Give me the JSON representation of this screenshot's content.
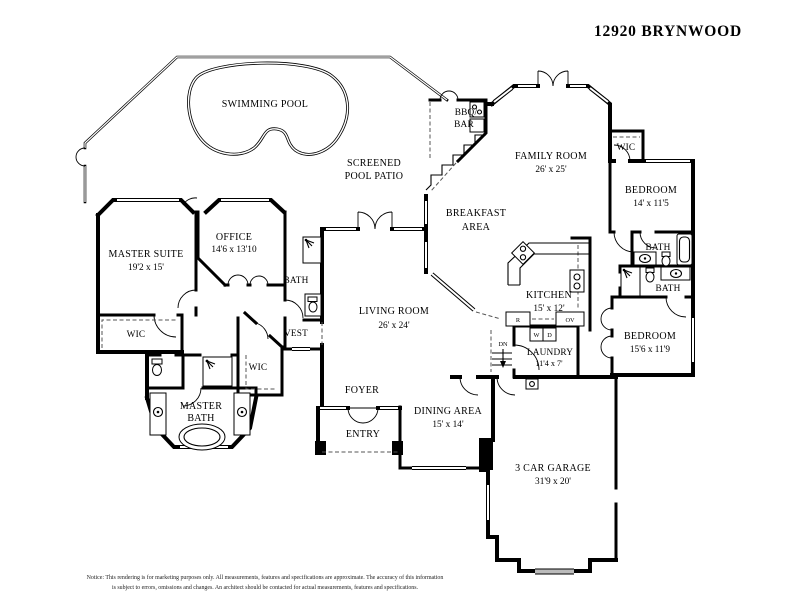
{
  "title": "12920 BRYNWOOD",
  "rooms": {
    "swimming_pool": {
      "label": "SWIMMING POOL"
    },
    "patio": {
      "line1": "SCREENED",
      "line2": "POOL PATIO"
    },
    "bbq_bar": {
      "line1": "BBQ/",
      "line2": "BAR"
    },
    "family_room": {
      "label": "FAMILY ROOM",
      "dim": "26' x 25'"
    },
    "wic_top": {
      "label": "WIC"
    },
    "bedroom1": {
      "label": "BEDROOM",
      "dim": "14' x 11'5"
    },
    "bath1": {
      "label": "BATH"
    },
    "bath2": {
      "label": "BATH"
    },
    "bedroom2": {
      "label": "BEDROOM",
      "dim": "15'6 x 11'9"
    },
    "breakfast": {
      "line1": "BREAKFAST",
      "line2": "AREA"
    },
    "kitchen": {
      "label": "KITCHEN",
      "dim": "15' x 12'"
    },
    "laundry": {
      "label": "LAUNDRY",
      "dim": "11'4 x 7'"
    },
    "master_suite": {
      "label": "MASTER SUITE",
      "dim": "19'2 x 15'"
    },
    "office": {
      "label": "OFFICE",
      "dim": "14'6 x 13'10"
    },
    "bath3": {
      "label": "BATH"
    },
    "vest": {
      "label": "VEST"
    },
    "living_room": {
      "label": "LIVING ROOM",
      "dim": "26' x 24'"
    },
    "wic_left": {
      "label": "WIC"
    },
    "wic_right": {
      "label": "WIC"
    },
    "master_bath": {
      "line1": "MASTER",
      "line2": "BATH"
    },
    "foyer": {
      "label": "FOYER"
    },
    "entry": {
      "label": "ENTRY"
    },
    "dining": {
      "label": "DINING AREA",
      "dim": "15' x 14'"
    },
    "garage": {
      "label": "3 CAR GARAGE",
      "dim": "31'9 x 20'"
    }
  },
  "markers": {
    "washer": "W",
    "dryer": "D",
    "range": "R",
    "oven": "OV",
    "down": "DN"
  },
  "notice": {
    "line1": "Notice: This rendering is for marketing purposes only. All measurements, features and specifications are approximate. The accuracy of this information",
    "line2": "is subject to errors, omissions and changes. An architect should be contacted for actual measurements, features and specifications."
  }
}
